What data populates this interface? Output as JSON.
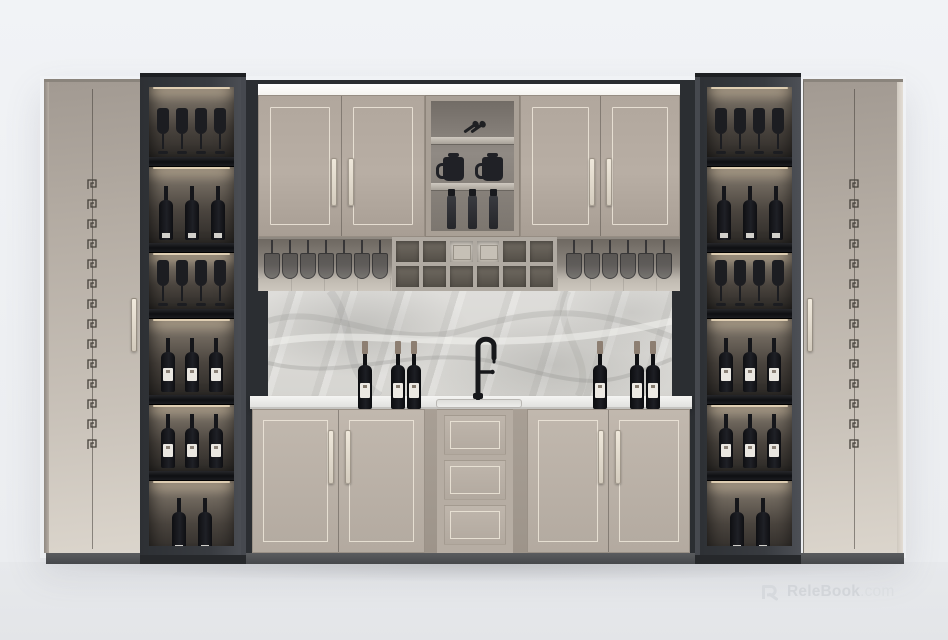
{
  "watermark": {
    "brand": "ReleBook",
    "suffix": ".com",
    "logo": "relebook-r-logo"
  },
  "scene": {
    "description": "3D interior render of a symmetric built-in home wine bar: champagne lacquer tall cabinets with Greek-key fret detail, charcoal display towers with lit shelves of wine bottles and stemware, greige upper and lower cabinets, marble backsplash, black gooseneck faucet with sink, wine cubby rack and hanging stemware."
  },
  "palette": {
    "wall": "#f0f2f5",
    "floor": "#e6e8eb",
    "cabinet_light": "#cfc8bf",
    "tower_dark": "#33363b",
    "door_greige": "#b5aba1",
    "trim": "#e6dfd2",
    "marble": "#dadad6",
    "counter": "#ececea",
    "plinth": "#515356",
    "bottle": "#131418",
    "bottle_label": "#ece9e3",
    "led_glow": "#ffeccb",
    "capsule": "#8d7f72",
    "faucet": "#17181b"
  },
  "left_tower": {
    "shelves": [
      {
        "content": "wine-glasses",
        "count": 4
      },
      {
        "content": "dark-bottles",
        "count": 3
      },
      {
        "content": "wine-glasses",
        "count": 4
      },
      {
        "content": "labeled-bottles",
        "count": 3
      },
      {
        "content": "labeled-bottles",
        "count": 3
      },
      {
        "content": "dark-bottles",
        "count": 2
      }
    ]
  },
  "right_tower": {
    "shelves": [
      {
        "content": "wine-glasses",
        "count": 4
      },
      {
        "content": "dark-bottles",
        "count": 3
      },
      {
        "content": "wine-glasses",
        "count": 4
      },
      {
        "content": "labeled-bottles",
        "count": 3
      },
      {
        "content": "labeled-bottles",
        "count": 3
      },
      {
        "content": "dark-bottles",
        "count": 2
      }
    ]
  },
  "upper_shelf_unit": {
    "compartments": [
      {
        "content": "ladles",
        "count": 2
      },
      {
        "content": "dark-jugs",
        "count": 2
      },
      {
        "content": "dark-bottles",
        "count": 3
      }
    ]
  },
  "wine_rack": {
    "rows": 2,
    "cols": 6,
    "box_cells": [
      [
        0,
        2
      ],
      [
        0,
        3
      ]
    ]
  },
  "hanging_glasses": {
    "left": 7,
    "right": 6
  },
  "counter": {
    "left_bottles": 3,
    "right_bottles": 3,
    "sink": "flush-mount",
    "faucet": "black-gooseneck"
  }
}
